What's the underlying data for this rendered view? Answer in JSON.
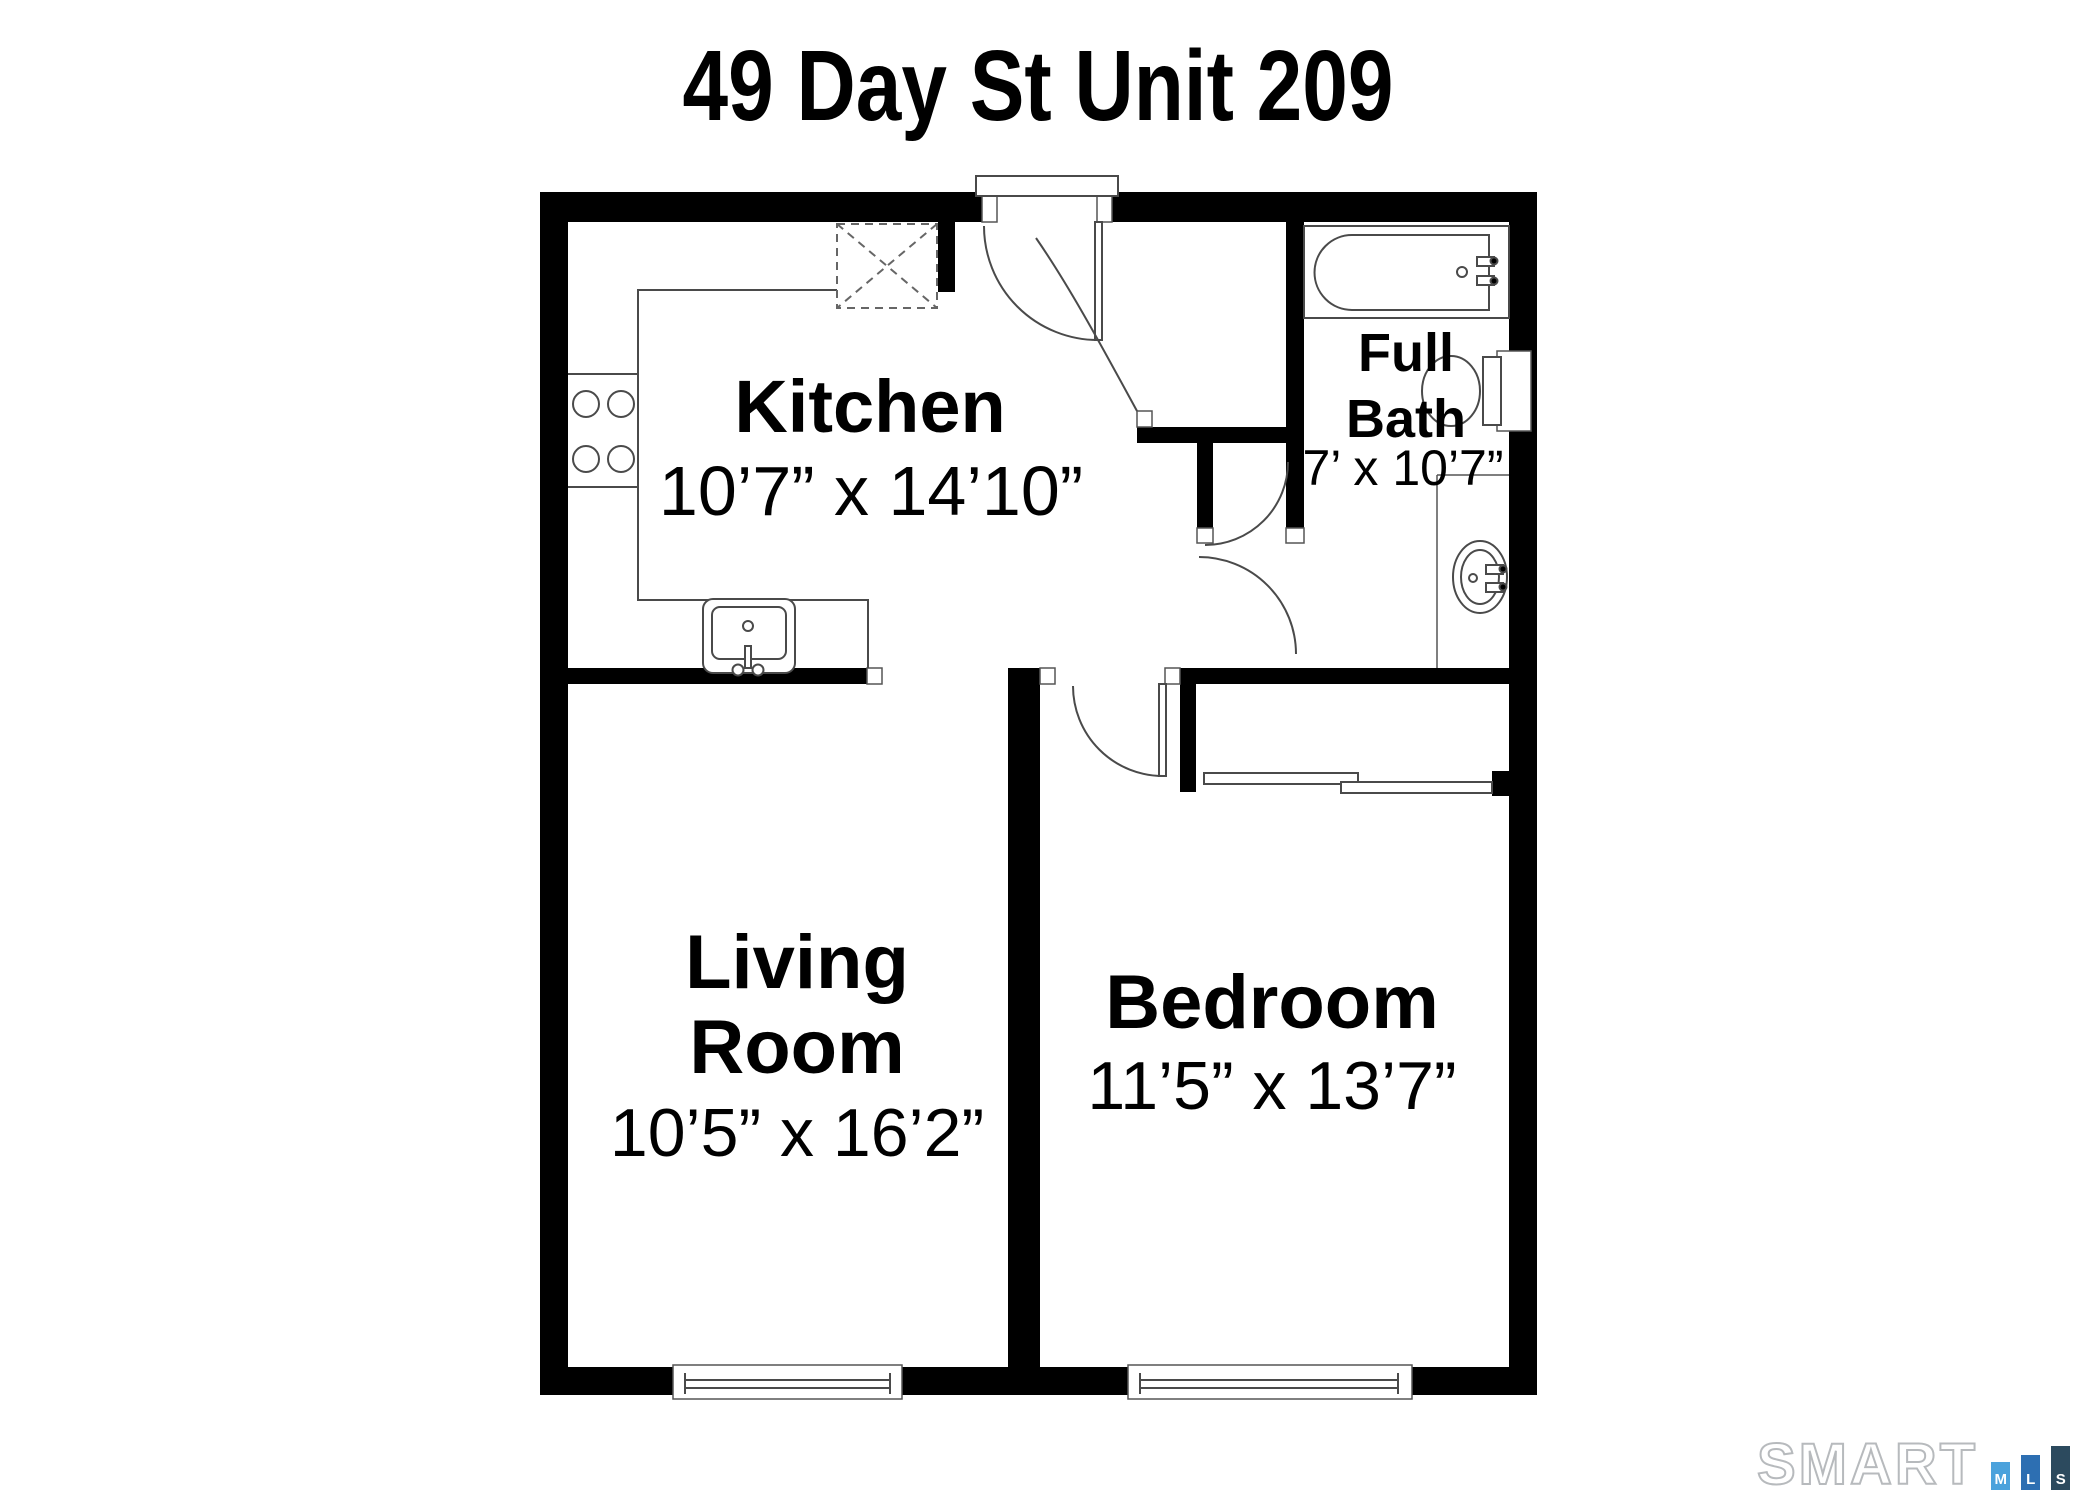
{
  "header": {
    "title": "49 Day St Unit 209"
  },
  "rooms": {
    "kitchen": {
      "name": "Kitchen",
      "dims": "10’7” x 14’10”"
    },
    "full_bath": {
      "name_line1": "Full",
      "name_line2": "Bath",
      "dims": "7’ x 10’7”"
    },
    "living_room": {
      "name_line1": "Living",
      "name_line2": "Room",
      "dims": "10’5” x 16’2”"
    },
    "bedroom": {
      "name": "Bedroom",
      "dims": "11’5” x 13’7”"
    }
  },
  "fixtures": [
    "bathtub",
    "toilet",
    "pedestal-sink",
    "kitchen-sink",
    "stove-4-burners",
    "refrigerator-dashed-box",
    "closet-sliding-doors",
    "entry-door",
    "bedroom-door",
    "bath-door",
    "living-room-window",
    "bedroom-window"
  ],
  "footer": {
    "brand": "SMART",
    "mls_letters": [
      "M",
      "L",
      "S"
    ],
    "colors": {
      "m_bar": "#4BA2DC",
      "l_bar": "#2D6FB2",
      "s_bar": "#2C4A5E",
      "brand_outline": "#B7BABD"
    }
  },
  "colors": {
    "walls": "#000000",
    "fixture_lines": "#4A4A4A",
    "background": "#FFFFFF",
    "text": "#000000"
  }
}
